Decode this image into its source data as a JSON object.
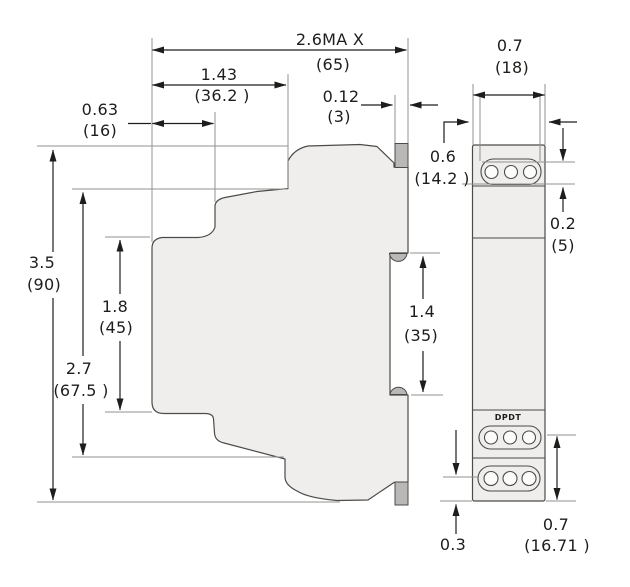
{
  "drawing": {
    "relay_label": "DPDT",
    "dimensions": {
      "overall_depth_max": {
        "inches": "2.6MA X",
        "mm": "(65)"
      },
      "upper_step_depth": {
        "inches": "1.43",
        "mm": "(36.2 )"
      },
      "top_step_depth": {
        "inches": "0.63",
        "mm": "(16)"
      },
      "rail_tab_thickness": {
        "inches": "0.12",
        "mm": "(3)"
      },
      "overall_height": {
        "inches": "3.5",
        "mm": "(90)"
      },
      "middle_height": {
        "inches": "2.7",
        "mm": "(67.5 )"
      },
      "body_height": {
        "inches": "1.8",
        "mm": "(45)"
      },
      "din_notch_height": {
        "inches": "1.4",
        "mm": "(35)"
      },
      "front_width": {
        "inches": "0.7",
        "mm": "(18)"
      },
      "front_inner_width": {
        "inches": "0.6",
        "mm": "(14.2 )"
      },
      "terminal_strip_inset": {
        "inches": "0.2",
        "mm": "(5)"
      },
      "terminal_zone_height": {
        "inches": "0.7",
        "mm": "(16.71 )"
      },
      "bottom_terminal_offset": {
        "inches": "0.3"
      }
    },
    "colors": {
      "background": "#ffffff",
      "module_fill": "#efeeec",
      "rail_clip_fill": "#b9b8b6",
      "outline": "#4b4b49",
      "extension_line": "#90908e",
      "dimension": "#1d1d1b"
    }
  }
}
